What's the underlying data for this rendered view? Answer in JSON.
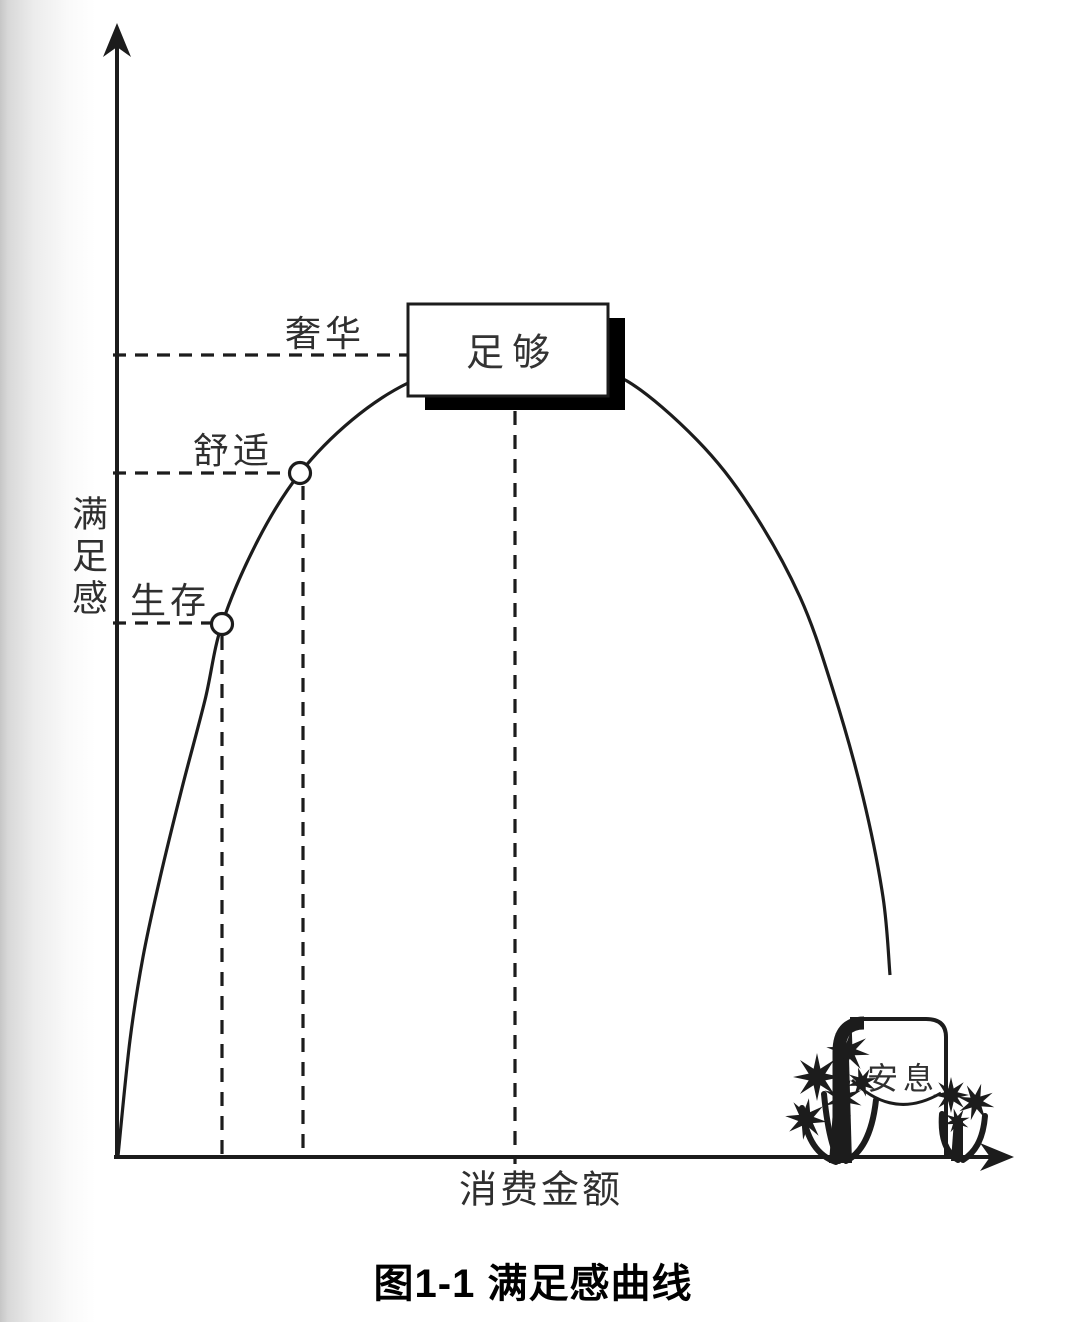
{
  "page": {
    "background": "#ffffff",
    "left_edge_scan_shadow": true
  },
  "colors": {
    "ink": "#1c1c1c",
    "label_text": "#2f2f2f",
    "caption_text": "#000000",
    "box_fill": "#ffffff",
    "shadow_fill": "#000000"
  },
  "figure": {
    "y_axis_label": "满足感",
    "x_axis_label": "消费金额",
    "labels": {
      "survival": "生存",
      "comfort": "舒适",
      "luxury": "奢华",
      "enough": "足够",
      "rest": "安息"
    },
    "caption": "图1-1 满足感曲线"
  },
  "chart_data": {
    "type": "line",
    "title": "图1-1 满足感曲线",
    "xlabel": "消费金额",
    "ylabel": "满足感",
    "grid": false,
    "legend": false,
    "description": "Conceptual satisfaction curve: satisfaction rises with spending through 生存 (survival) and 舒适 (comfort) levels, peaks at 足够 (enough) just above the 奢华 (luxury) level, then falls as spending keeps growing, ending at a grave marked 安息 (rest).",
    "series": [
      {
        "name": "满足感曲线",
        "points_px": [
          [
            118,
            1156
          ],
          [
            130,
            1040
          ],
          [
            143,
            957
          ],
          [
            160,
            878
          ],
          [
            182,
            788
          ],
          [
            205,
            700
          ],
          [
            222,
            624
          ],
          [
            258,
            540
          ],
          [
            300,
            473
          ],
          [
            352,
            420
          ],
          [
            408,
            383
          ],
          [
            460,
            367
          ],
          [
            516,
            362
          ],
          [
            572,
            367
          ],
          [
            627,
            381
          ],
          [
            697,
            440
          ],
          [
            750,
            507
          ],
          [
            800,
            597
          ],
          [
            833,
            690
          ],
          [
            863,
            797
          ],
          [
            883,
            897
          ],
          [
            890,
            975
          ]
        ]
      }
    ],
    "annotations": [
      {
        "label": "生存",
        "marker": "circle",
        "point_px": [
          222,
          624
        ]
      },
      {
        "label": "舒适",
        "marker": "circle",
        "point_px": [
          300,
          473
        ]
      },
      {
        "label": "奢华",
        "level_y_px": 355
      },
      {
        "label": "足够",
        "style": "boxed",
        "at_peak": true
      },
      {
        "label": "安息",
        "style": "tombstone",
        "at_end": true
      }
    ],
    "x_axis_px": {
      "y": 1157,
      "x1": 114,
      "x2": 994,
      "arrow_tip_x": 1014
    },
    "y_axis_px": {
      "x": 117,
      "y1": 1159,
      "y2": 44,
      "arrow_tip_y": 23
    },
    "dashed_h_px": [
      {
        "for": "奢华",
        "y": 355,
        "x1": 113,
        "x2": 408
      },
      {
        "for": "舒适",
        "y": 473,
        "x1": 113,
        "x2": 290
      },
      {
        "for": "生存",
        "y": 623,
        "x1": 113,
        "x2": 213
      }
    ],
    "dashed_v_px": [
      {
        "x": 222,
        "y1": 636,
        "y2": 1157
      },
      {
        "x": 303,
        "y1": 486,
        "y2": 1157
      },
      {
        "x": 515,
        "y1": 411,
        "y2": 1164
      }
    ],
    "marker_radius_px": 10.5,
    "enough_box_px": {
      "x": 408,
      "y": 304,
      "w": 200,
      "h": 92,
      "shadow_dx": 17,
      "shadow_dy": 14
    }
  },
  "decor": {
    "tombstone": {
      "body_fill": "M 841 1156 L 841 1050 Q 841 1021 868 1021 L 924 1021 Q 944 1021 944 1039 L 944 1156 Z",
      "outline": "M 850 1019 L 926 1019 Q 946 1019 946 1037 L 946 1156",
      "heavy_left_edge": "M 864 1023 Q 839 1023 839 1052 L 839 1158",
      "ribbon": "M 852 1080 C 882 1110 912 1110 941 1093"
    },
    "flowers": {
      "left": {
        "blossoms": [
          {
            "cx": 848,
            "cy": 1051,
            "ro": 22,
            "ri": 8,
            "rot": 10
          },
          {
            "cx": 817,
            "cy": 1077,
            "ro": 24,
            "ri": 9,
            "rot": 0
          },
          {
            "cx": 843,
            "cy": 1098,
            "ro": 20,
            "ri": 7,
            "rot": 22
          },
          {
            "cx": 806,
            "cy": 1119,
            "ro": 21,
            "ri": 8,
            "rot": 8
          },
          {
            "cx": 862,
            "cy": 1082,
            "ro": 15,
            "ri": 6,
            "rot": 30
          }
        ],
        "stems": [
          "M 802 1108 C 806 1140 818 1156 836 1162",
          "M 876 1100 C 872 1136 860 1154 846 1161",
          "M 824 1094 C 827 1126 832 1148 839 1161"
        ],
        "trunk": "M 837 1058 L 829 1163 L 852 1163 L 849 1058 Z"
      },
      "right": {
        "blossoms": [
          {
            "cx": 951,
            "cy": 1095,
            "ro": 18,
            "ri": 7,
            "rot": 0
          },
          {
            "cx": 976,
            "cy": 1102,
            "ro": 19,
            "ri": 7,
            "rot": 16
          },
          {
            "cx": 957,
            "cy": 1121,
            "ro": 13,
            "ri": 5,
            "rot": 30
          }
        ],
        "stems": [
          "M 942 1114 C 940 1140 947 1153 958 1160",
          "M 985 1116 C 983 1141 974 1153 963 1160"
        ],
        "trunk": "M 954 1120 L 951 1161 L 963 1161 L 963 1120 Z"
      }
    }
  }
}
